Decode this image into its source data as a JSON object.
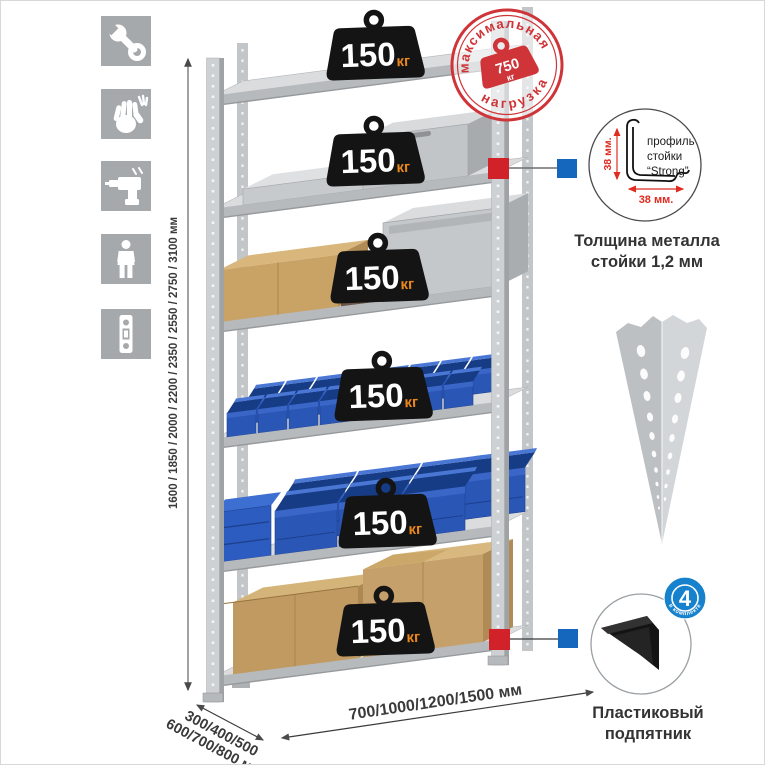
{
  "colors": {
    "icon_tile": "#a6a9ac",
    "stamp_red": "#cf3538",
    "badge_black": "#141414",
    "badge_unit_orange": "#e9871c",
    "callout_red": "#d12129",
    "callout_blue": "#1566bd",
    "bin_blue": "#2a57b6",
    "text_dark": "#3a3a3a",
    "dim_red": "#e02b20"
  },
  "sidebar_icons": [
    {
      "name": "wrench-icon"
    },
    {
      "name": "gloves-icon"
    },
    {
      "name": "drill-icon"
    },
    {
      "name": "person-icon"
    },
    {
      "name": "level-icon"
    }
  ],
  "stamp": {
    "arc_top": "максимальная",
    "arc_bottom": "нагрузка",
    "weight_value": "750",
    "weight_unit": "кг"
  },
  "shelf_badge": {
    "value": "150",
    "unit": "кг"
  },
  "dimensions": {
    "height": "1600 / 1850 / 2000 / 2200 / 2350 / 2550 / 2750 / 3100 мм",
    "depth_line1": "300/400/500",
    "depth_line2": "600/700/800 мм",
    "width": "700/1000/1200/1500 мм"
  },
  "profile_detail": {
    "label_line1": "профиль",
    "label_line2": "стойки",
    "label_line3": "“Strong”",
    "dim_vertical": "38 мм.",
    "dim_horizontal": "38 мм.",
    "caption_line1": "Толщина металла",
    "caption_line2": "стойки 1,2 мм"
  },
  "foot_detail": {
    "badge_number": "4",
    "badge_ring_text": "в комплекте",
    "caption_line1": "Пластиковый",
    "caption_line2": "подпятник"
  }
}
